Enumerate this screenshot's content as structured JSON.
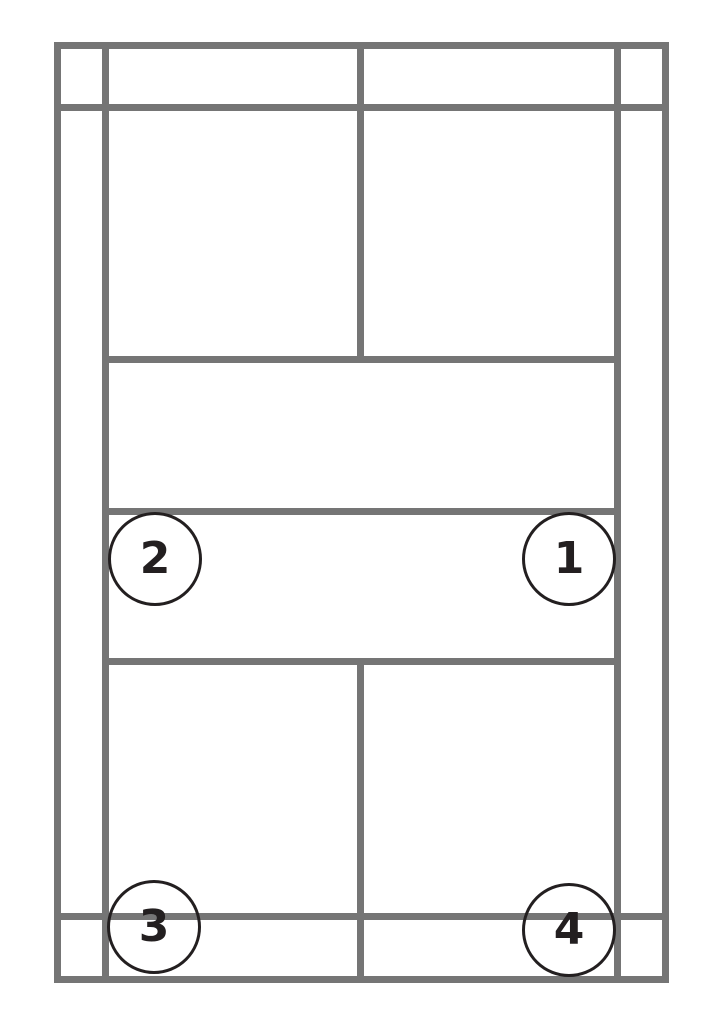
{
  "diagram": {
    "background_color": "#ffffff",
    "line_color": "#757575",
    "marker_stroke_color": "#231f20",
    "marker_label_color": "#231f20",
    "markers": [
      {
        "label": "1",
        "position": "middle-right"
      },
      {
        "label": "2",
        "position": "middle-left"
      },
      {
        "label": "3",
        "position": "bottom-left"
      },
      {
        "label": "4",
        "position": "bottom-right"
      }
    ]
  }
}
